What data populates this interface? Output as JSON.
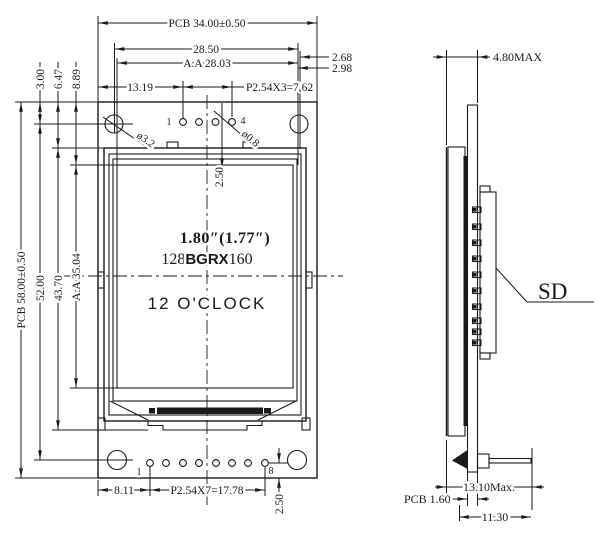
{
  "front": {
    "dims": {
      "pcb_w": "PCB 34.00±0.50",
      "span_28_50": "28.50",
      "aa_w": "A.A 28.03",
      "off_13_19": "13.19",
      "pitch_top": "P2.54X3=7.62",
      "edge_2_68": "2.68",
      "edge_2_98": "2.98",
      "d3_00": "3.00",
      "d6_47": "6.47",
      "d8_89": "8.89",
      "pcb_h": "PCB 58.00±0.50",
      "span_52": "52.00",
      "mod_h": "43.70",
      "aa_h": "A.A 35.04",
      "top_2_50": "2.50",
      "bot_2_50": "2.50",
      "off_8_11": "8.11",
      "pitch_bot": "P2.54X7=17.78",
      "hole_d": "ø3.2",
      "pin_d": "ø0.8"
    },
    "pins": {
      "top_first": "1",
      "top_last": "4",
      "bot_first": "1",
      "bot_last": "8"
    },
    "screen": {
      "size": "1.80″(1.77″)",
      "res_a": "128",
      "res_b": "BGRX",
      "res_c": "160",
      "mode": "12 O'CLOCK"
    }
  },
  "side": {
    "dims": {
      "thk": "4.80MAX",
      "pin_len": "13.10Max.",
      "pcb_t": "PCB 1.60",
      "depth": "11.30"
    },
    "sd": "SD"
  },
  "colors": {
    "ink": "#1a1a1a",
    "paper": "#ffffff"
  }
}
